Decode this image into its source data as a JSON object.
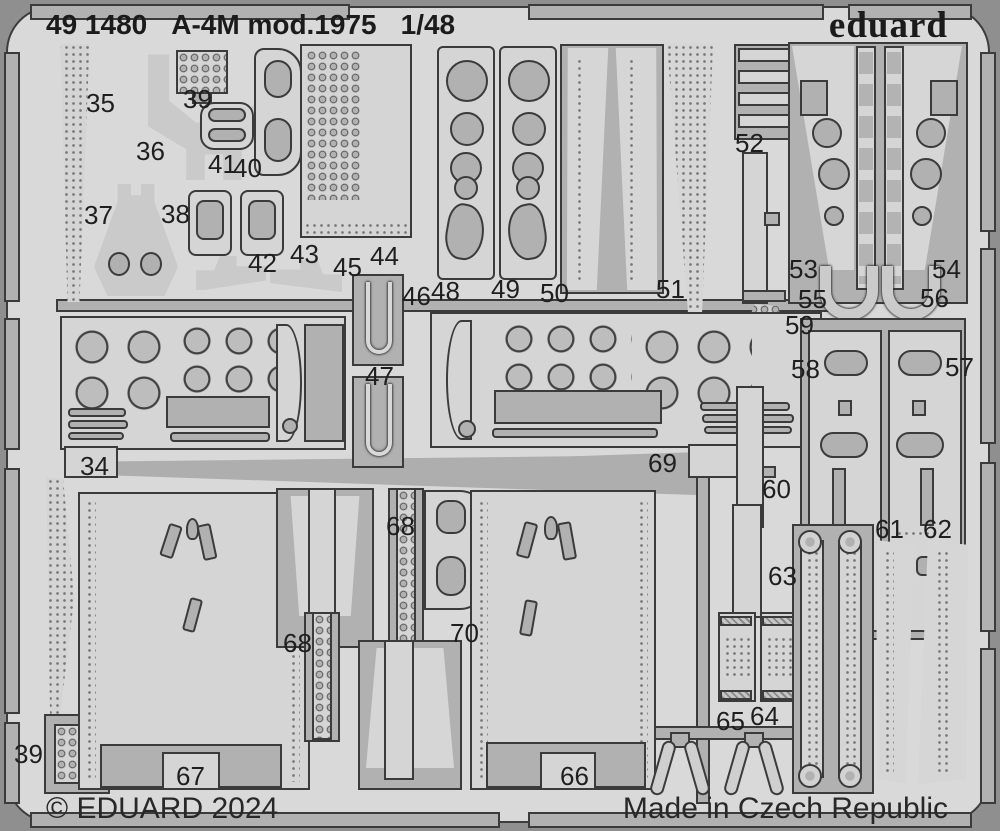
{
  "sheet": {
    "catalog_number": "49 1480",
    "title": "A-4M mod.1975",
    "scale": "1/48",
    "brand": "eduard",
    "copyright": "© EDUARD 2024",
    "made_in": "Made in Czech Republic"
  },
  "colors": {
    "background": "#8f8f8f",
    "fret_surface": "#d9d9d9",
    "etched_area": "#b1b1b1",
    "part_fill": "#d5d5d5",
    "outline": "#3b3b3b",
    "text": "#1b1b1b"
  },
  "part_labels": [
    {
      "number": "35",
      "x": 86,
      "y": 90
    },
    {
      "number": "39",
      "x": 183,
      "y": 86
    },
    {
      "number": "36",
      "x": 136,
      "y": 138
    },
    {
      "number": "41",
      "x": 208,
      "y": 151
    },
    {
      "number": "40",
      "x": 233,
      "y": 155
    },
    {
      "number": "37",
      "x": 84,
      "y": 202
    },
    {
      "number": "38",
      "x": 161,
      "y": 201
    },
    {
      "number": "42",
      "x": 248,
      "y": 250
    },
    {
      "number": "43",
      "x": 290,
      "y": 241
    },
    {
      "number": "45",
      "x": 333,
      "y": 254
    },
    {
      "number": "44",
      "x": 370,
      "y": 243
    },
    {
      "number": "46",
      "x": 402,
      "y": 283
    },
    {
      "number": "48",
      "x": 431,
      "y": 278
    },
    {
      "number": "49",
      "x": 491,
      "y": 276
    },
    {
      "number": "50",
      "x": 540,
      "y": 280
    },
    {
      "number": "51",
      "x": 656,
      "y": 276
    },
    {
      "number": "52",
      "x": 735,
      "y": 130
    },
    {
      "number": "53",
      "x": 789,
      "y": 256
    },
    {
      "number": "54",
      "x": 932,
      "y": 256
    },
    {
      "number": "55",
      "x": 798,
      "y": 286
    },
    {
      "number": "56",
      "x": 920,
      "y": 285
    },
    {
      "number": "59",
      "x": 785,
      "y": 312
    },
    {
      "number": "58",
      "x": 791,
      "y": 356
    },
    {
      "number": "57",
      "x": 945,
      "y": 354
    },
    {
      "number": "47",
      "x": 365,
      "y": 363
    },
    {
      "number": "34",
      "x": 80,
      "y": 453
    },
    {
      "number": "69",
      "x": 648,
      "y": 450
    },
    {
      "number": "60",
      "x": 762,
      "y": 476
    },
    {
      "number": "61",
      "x": 875,
      "y": 516
    },
    {
      "number": "62",
      "x": 923,
      "y": 516
    },
    {
      "number": "68",
      "x": 386,
      "y": 513
    },
    {
      "number": "63",
      "x": 768,
      "y": 563
    },
    {
      "number": "70",
      "x": 450,
      "y": 620
    },
    {
      "number": "68",
      "x": 283,
      "y": 630
    },
    {
      "number": "64",
      "x": 750,
      "y": 703
    },
    {
      "number": "65",
      "x": 716,
      "y": 708
    },
    {
      "number": "39",
      "x": 14,
      "y": 741
    },
    {
      "number": "67",
      "x": 176,
      "y": 763
    },
    {
      "number": "66",
      "x": 560,
      "y": 763
    }
  ]
}
